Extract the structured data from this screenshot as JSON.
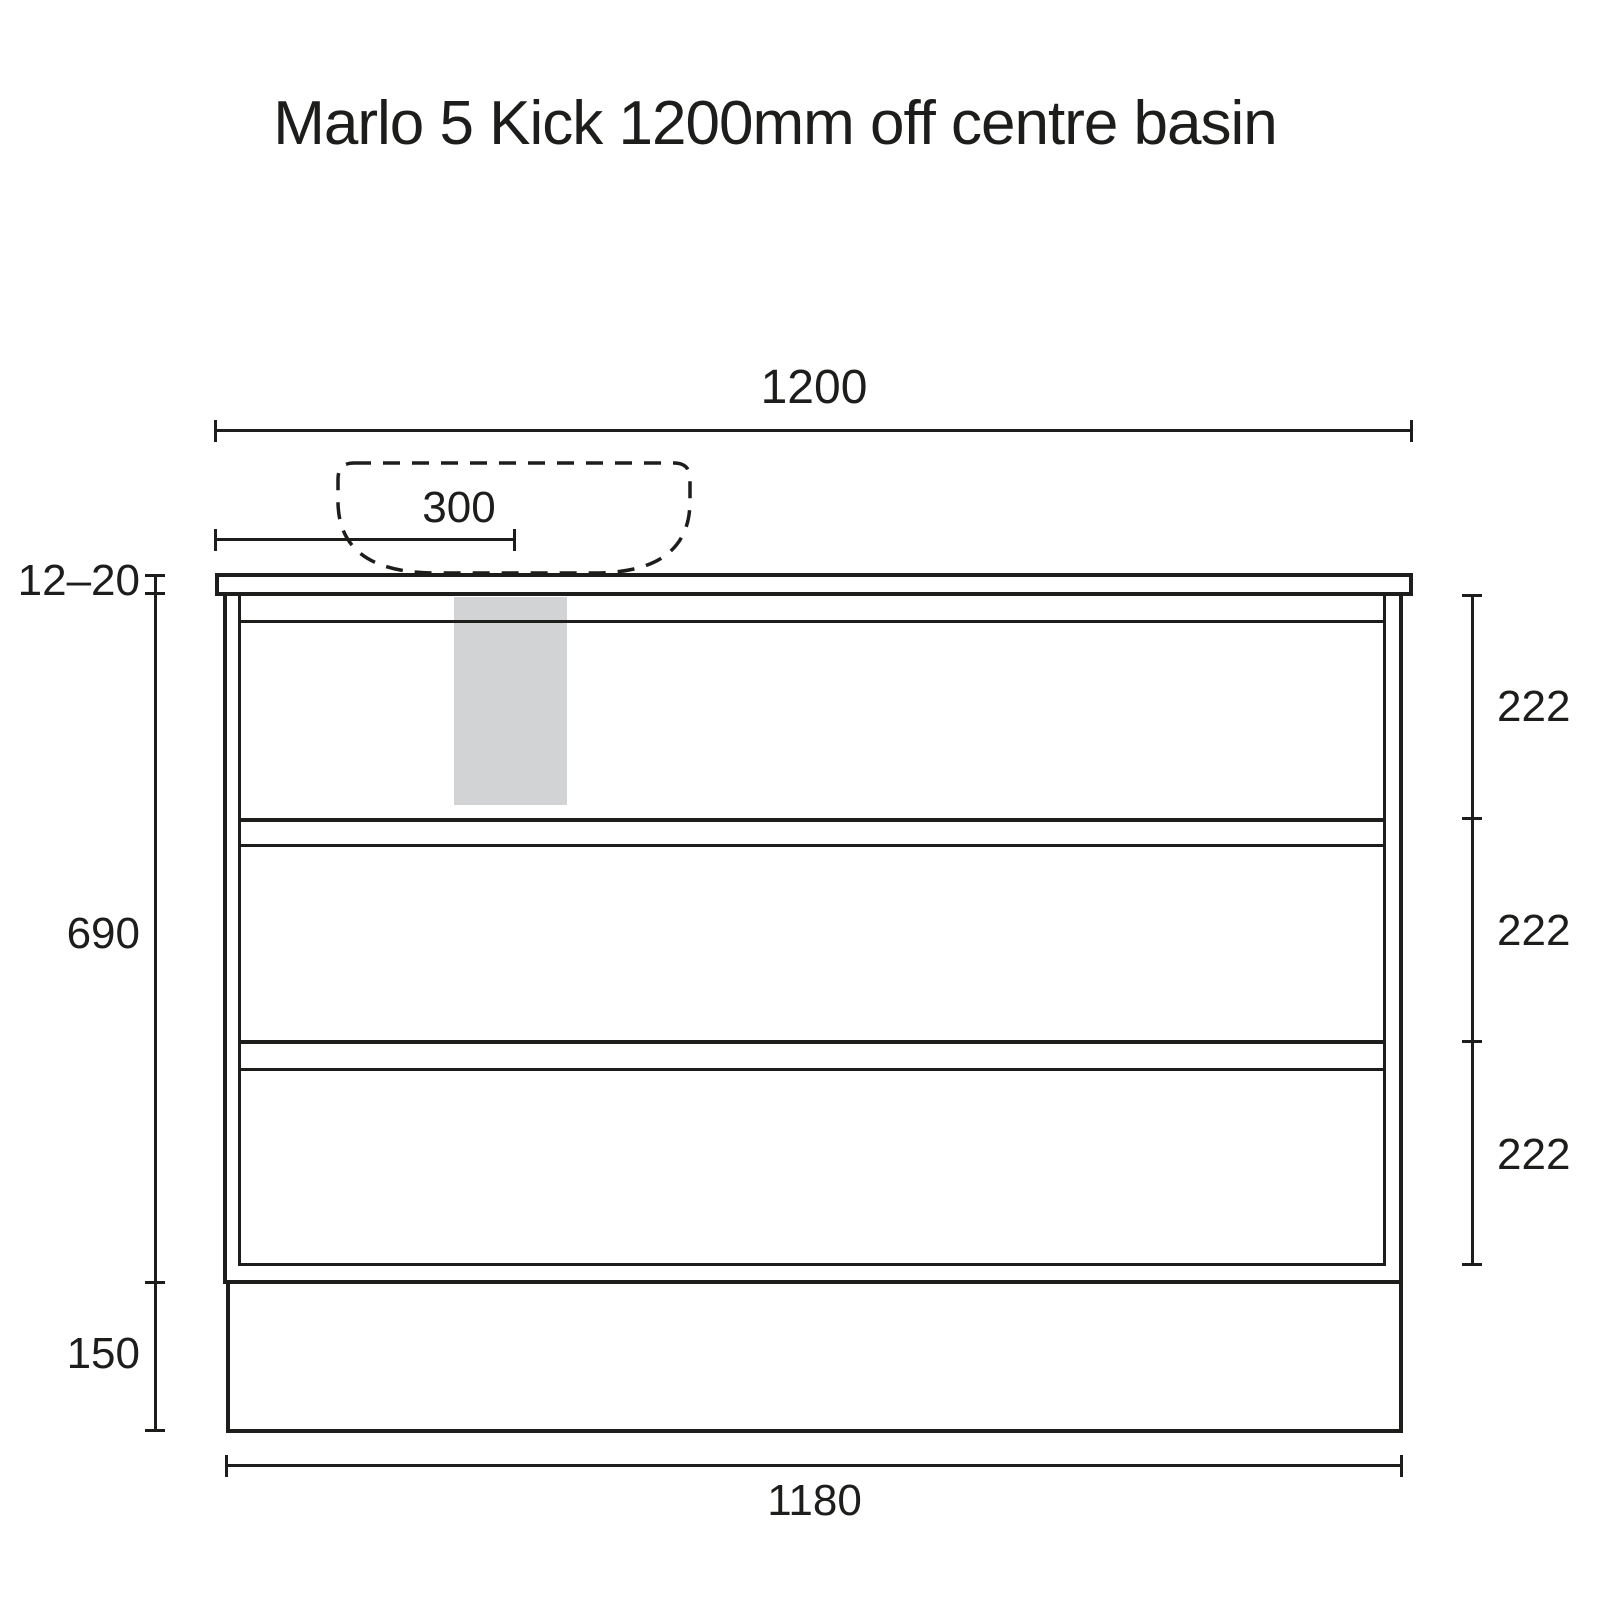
{
  "title": "Marlo 5 Kick 1200mm off centre basin",
  "dimensions": {
    "overall_width": "1200",
    "basin_centre_offset": "300",
    "benchtop_thickness": "12–20",
    "cabinet_height": "690",
    "kick_height": "150",
    "drawer_heights": [
      "222",
      "222",
      "222"
    ],
    "base_width": "1180"
  },
  "colors": {
    "line": "#1d1d1b",
    "highlight_fill": "#d2d3d5",
    "background": "#ffffff"
  }
}
